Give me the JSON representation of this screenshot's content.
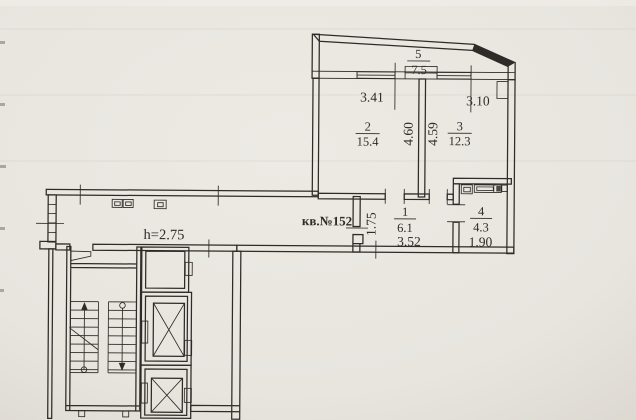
{
  "plan": {
    "apartment_label": "кв.№152",
    "ceiling_height_label": "h=2.75",
    "rooms": [
      {
        "number": "1",
        "area": "6.1"
      },
      {
        "number": "2",
        "area": "15.4"
      },
      {
        "number": "3",
        "area": "12.3"
      },
      {
        "number": "4",
        "area": "4.3"
      },
      {
        "number": "5",
        "area": "7.5"
      }
    ],
    "dimensions": {
      "room2_width": "3.41",
      "room3_width": "3.10",
      "room2_depth": "4.60",
      "room3_depth": "4.59",
      "hall_depth": "1.75",
      "hall_width": "3.52",
      "bath_width": "1.90"
    },
    "colors": {
      "paper": "#e8e5df",
      "ink": "#2e2b28"
    }
  }
}
